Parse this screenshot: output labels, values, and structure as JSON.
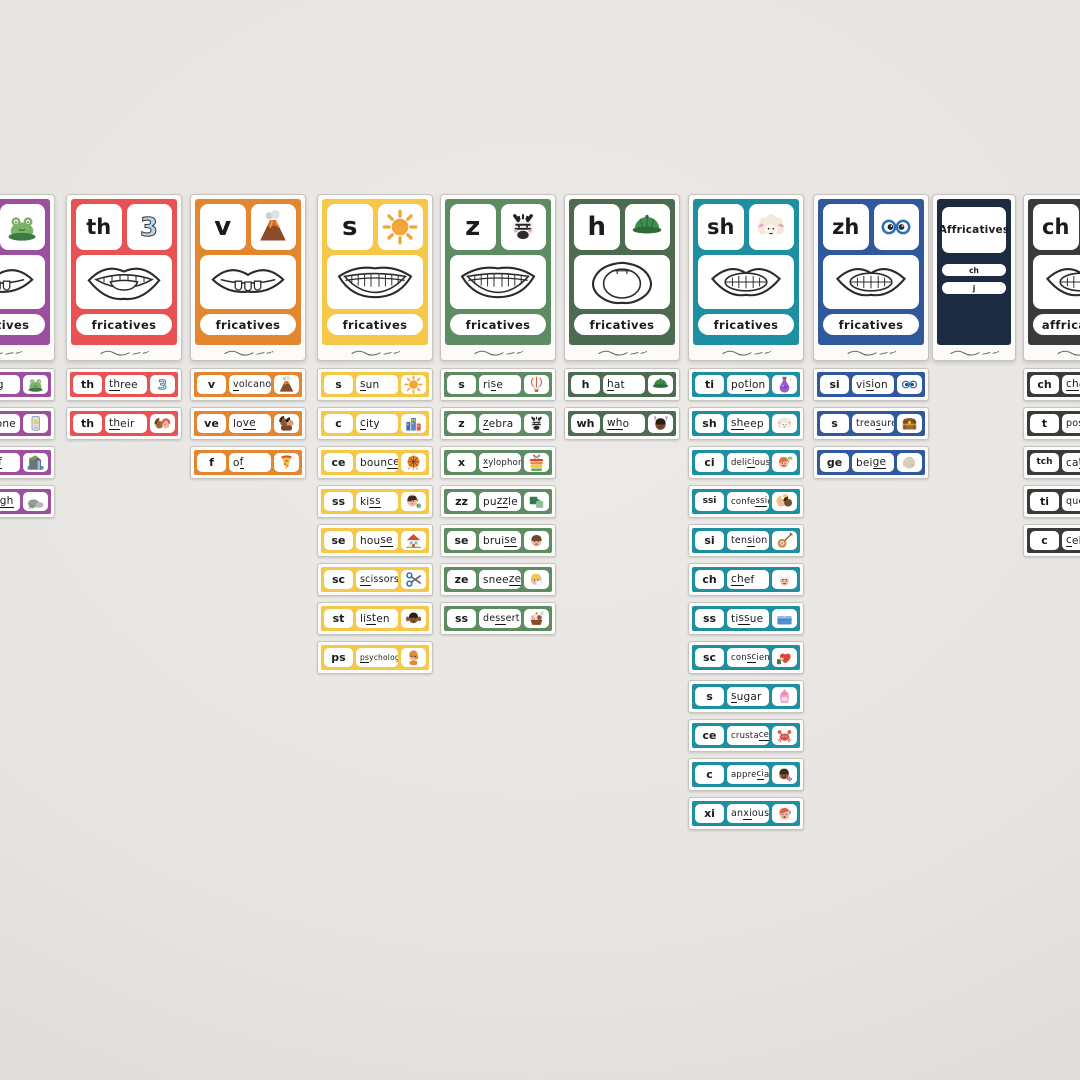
{
  "board": {
    "description": "phonics flashcard flat-lay",
    "background_color": "#e7e5e2",
    "card_paper_color": "#fcfbf9"
  },
  "columns": [
    {
      "id": "f",
      "type": "phoneme",
      "x": -61,
      "width": 116,
      "color": "#9c4f9e",
      "main": {
        "letter": "f",
        "image": "frog-icon",
        "mouth": "labiodental",
        "label": "fricatives"
      },
      "words": [
        {
          "grapheme": "f",
          "before": "",
          "target": "f",
          "after": "rog",
          "icon": "frog-icon"
        },
        {
          "grapheme": "ph",
          "before": "",
          "target": "ph",
          "after": "one",
          "icon": "phone-icon"
        },
        {
          "grapheme": "ff",
          "before": "cli",
          "target": "ff",
          "after": "",
          "icon": "cliff-icon"
        },
        {
          "grapheme": "gh",
          "before": "rou",
          "target": "gh",
          "after": "",
          "icon": "rocks-icon"
        }
      ]
    },
    {
      "id": "th",
      "type": "phoneme",
      "x": 66,
      "width": 116,
      "color": "#e85252",
      "main": {
        "letter": "th",
        "image": "number-three-icon",
        "mouth": "interdental",
        "label": "fricatives"
      },
      "words": [
        {
          "grapheme": "th",
          "before": "",
          "target": "th",
          "after": "ree",
          "icon": "number-three-icon"
        },
        {
          "grapheme": "th",
          "before": "",
          "target": "th",
          "after": "eir",
          "icon": "two-kids-icon"
        }
      ]
    },
    {
      "id": "v",
      "type": "phoneme",
      "x": 190,
      "width": 116,
      "color": "#e2872f",
      "main": {
        "letter": "v",
        "image": "volcano-icon",
        "mouth": "labiodental",
        "label": "fricatives"
      },
      "words": [
        {
          "grapheme": "v",
          "before": "",
          "target": "v",
          "after": "olcano",
          "icon": "volcano-icon"
        },
        {
          "grapheme": "ve",
          "before": "lo",
          "target": "ve",
          "after": "",
          "icon": "hug-icon"
        },
        {
          "grapheme": "f",
          "before": "o",
          "target": "f",
          "after": "",
          "icon": "pizza-icon"
        }
      ]
    },
    {
      "id": "s",
      "type": "phoneme",
      "x": 317,
      "width": 116,
      "color": "#f6c84a",
      "main": {
        "letter": "s",
        "image": "sun-icon",
        "mouth": "teeth-smile",
        "label": "fricatives"
      },
      "words": [
        {
          "grapheme": "s",
          "before": "",
          "target": "s",
          "after": "un",
          "icon": "sun-icon"
        },
        {
          "grapheme": "c",
          "before": "",
          "target": "c",
          "after": "ity",
          "icon": "city-icon"
        },
        {
          "grapheme": "ce",
          "before": "boun",
          "target": "ce",
          "after": "",
          "icon": "basketball-icon"
        },
        {
          "grapheme": "ss",
          "before": "ki",
          "target": "ss",
          "after": "",
          "icon": "princess-kiss-icon"
        },
        {
          "grapheme": "se",
          "before": "hou",
          "target": "se",
          "after": "",
          "icon": "house-icon"
        },
        {
          "grapheme": "sc",
          "before": "",
          "target": "sc",
          "after": "issors",
          "icon": "scissors-icon"
        },
        {
          "grapheme": "st",
          "before": "li",
          "target": "st",
          "after": "en",
          "icon": "listening-icon"
        },
        {
          "grapheme": "ps",
          "before": "",
          "target": "ps",
          "after": "ychologist",
          "icon": "psychologist-icon"
        }
      ]
    },
    {
      "id": "z",
      "type": "phoneme",
      "x": 440,
      "width": 116,
      "color": "#5d8b62",
      "main": {
        "letter": "z",
        "image": "zebra-icon",
        "mouth": "teeth-smile",
        "label": "fricatives"
      },
      "words": [
        {
          "grapheme": "s",
          "before": "ri",
          "target": "s",
          "after": "e",
          "icon": "balloon-icon"
        },
        {
          "grapheme": "z",
          "before": "",
          "target": "z",
          "after": "ebra",
          "icon": "zebra-icon"
        },
        {
          "grapheme": "x",
          "before": "",
          "target": "x",
          "after": "ylophone",
          "icon": "xylophone-icon"
        },
        {
          "grapheme": "zz",
          "before": "pu",
          "target": "zz",
          "after": "le",
          "icon": "puzzle-icon"
        },
        {
          "grapheme": "se",
          "before": "brui",
          "target": "se",
          "after": "",
          "icon": "bruise-icon"
        },
        {
          "grapheme": "ze",
          "before": "snee",
          "target": "ze",
          "after": "",
          "icon": "sneeze-icon"
        },
        {
          "grapheme": "ss",
          "before": "de",
          "target": "ss",
          "after": "ert",
          "icon": "dessert-icon"
        }
      ]
    },
    {
      "id": "h",
      "type": "phoneme",
      "x": 564,
      "width": 116,
      "color": "#4c6b50",
      "main": {
        "letter": "h",
        "image": "cap-icon",
        "mouth": "open",
        "label": "fricatives"
      },
      "words": [
        {
          "grapheme": "h",
          "before": "",
          "target": "h",
          "after": "at",
          "icon": "cap-icon"
        },
        {
          "grapheme": "wh",
          "before": "",
          "target": "wh",
          "after": "o",
          "icon": "who-icon"
        }
      ]
    },
    {
      "id": "sh",
      "type": "phoneme",
      "x": 688,
      "width": 116,
      "color": "#1d8fa0",
      "main": {
        "letter": "sh",
        "image": "sheep-icon",
        "mouth": "rounded-teeth",
        "label": "fricatives"
      },
      "words": [
        {
          "grapheme": "ti",
          "before": "po",
          "target": "ti",
          "after": "on",
          "icon": "potion-icon"
        },
        {
          "grapheme": "sh",
          "before": "",
          "target": "sh",
          "after": "eep",
          "icon": "sheep-icon"
        },
        {
          "grapheme": "ci",
          "before": "deli",
          "target": "ci",
          "after": "ous",
          "icon": "delicious-icon"
        },
        {
          "grapheme": "ssi",
          "before": "confe",
          "target": "ssi",
          "after": "on",
          "icon": "confession-icon"
        },
        {
          "grapheme": "si",
          "before": "ten",
          "target": "si",
          "after": "on",
          "icon": "banjo-icon"
        },
        {
          "grapheme": "ch",
          "before": "",
          "target": "ch",
          "after": "ef",
          "icon": "chef-icon"
        },
        {
          "grapheme": "ss",
          "before": "ti",
          "target": "ss",
          "after": "ue",
          "icon": "tissue-icon"
        },
        {
          "grapheme": "sc",
          "before": "con",
          "target": "sc",
          "after": "ience",
          "icon": "conscience-icon"
        },
        {
          "grapheme": "s",
          "before": "",
          "target": "s",
          "after": "ugar",
          "icon": "sugar-icon"
        },
        {
          "grapheme": "ce",
          "before": "crusta",
          "target": "ce",
          "after": "an",
          "icon": "crab-icon"
        },
        {
          "grapheme": "c",
          "before": "appre",
          "target": "ci",
          "after": "ate",
          "icon": "appreciate-icon"
        },
        {
          "grapheme": "xi",
          "before": "an",
          "target": "xi",
          "after": "ous",
          "icon": "anxious-icon"
        }
      ]
    },
    {
      "id": "zh",
      "type": "phoneme",
      "x": 813,
      "width": 116,
      "color": "#30589d",
      "main": {
        "letter": "zh",
        "image": "glasses-icon",
        "mouth": "rounded-teeth",
        "label": "fricatives"
      },
      "words": [
        {
          "grapheme": "si",
          "before": "vi",
          "target": "si",
          "after": "on",
          "icon": "glasses-icon"
        },
        {
          "grapheme": "s",
          "before": "trea",
          "target": "s",
          "after": "ure",
          "icon": "treasure-icon"
        },
        {
          "grapheme": "ge",
          "before": "bei",
          "target": "ge",
          "after": "",
          "icon": "beige-icon"
        }
      ]
    },
    {
      "id": "affricatives-title",
      "type": "title",
      "x": 932,
      "width": 84,
      "color": "#1d2b42",
      "title": "Affricatives",
      "pills": [
        "ch",
        "j"
      ]
    },
    {
      "id": "ch",
      "type": "phoneme",
      "x": 1023,
      "width": 116,
      "color": "#3b3a3a",
      "main": {
        "letter": "ch",
        "image": null,
        "mouth": "rounded-teeth",
        "label": "affricatives"
      },
      "words": [
        {
          "grapheme": "ch",
          "before": "",
          "target": "ch",
          "after": "erry",
          "icon": null
        },
        {
          "grapheme": "t",
          "before": "pos",
          "target": "t",
          "after": "ure",
          "icon": null
        },
        {
          "grapheme": "tch",
          "before": "ca",
          "target": "tch",
          "after": "",
          "icon": null
        },
        {
          "grapheme": "ti",
          "before": "ques",
          "target": "ti",
          "after": "on",
          "icon": null
        },
        {
          "grapheme": "c",
          "before": "",
          "target": "c",
          "after": "ello",
          "icon": null
        }
      ]
    }
  ]
}
